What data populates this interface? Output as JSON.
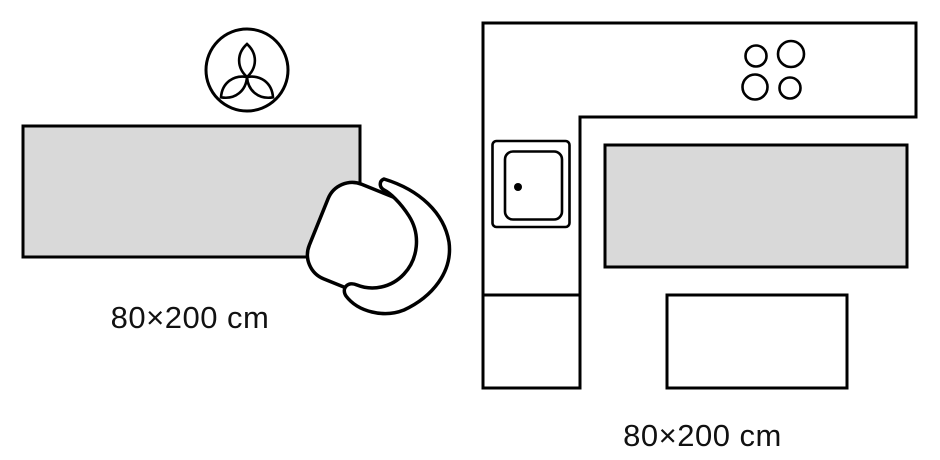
{
  "colors": {
    "background": "#ffffff",
    "outline": "#000000",
    "rug_fill": "#d9d9d9"
  },
  "left_diagram": {
    "size_label": "80×200 cm",
    "icons": [
      "plant-icon",
      "rug-swatch",
      "armchair-icon"
    ]
  },
  "right_diagram": {
    "size_label": "80×200 cm",
    "icons": [
      "kitchen-counter-icon",
      "hob-burners-icon",
      "appliance-icon",
      "rug-swatch",
      "table-icon"
    ]
  }
}
